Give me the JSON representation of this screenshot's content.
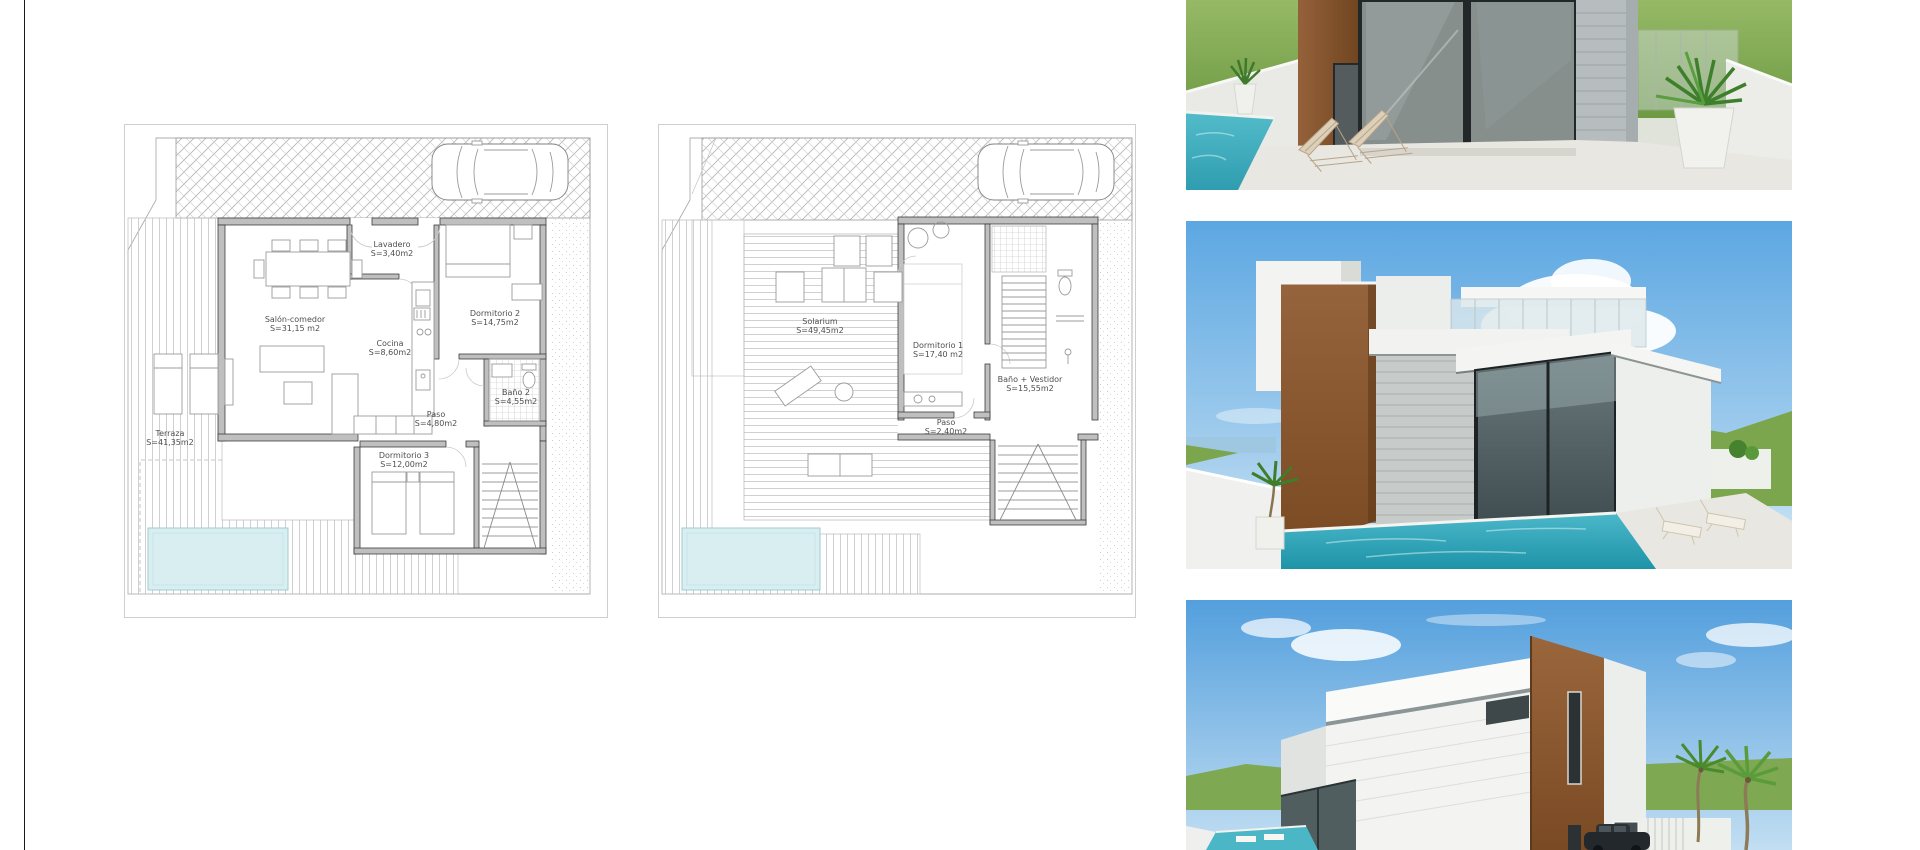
{
  "plans": [
    {
      "name": "ground-floor-plan",
      "rooms": [
        {
          "label": "Salón-comedor",
          "area": "S=31,15 m2"
        },
        {
          "label": "Lavadero",
          "area": "S=3,40m2"
        },
        {
          "label": "Cocina",
          "area": "S=8,60m2"
        },
        {
          "label": "Dormitorio 2",
          "area": "S=14,75m2"
        },
        {
          "label": "Baño 2",
          "area": "S=4,55m2"
        },
        {
          "label": "Paso",
          "area": "S=4,80m2"
        },
        {
          "label": "Dormitorio 3",
          "area": "S=12,00m2"
        },
        {
          "label": "Terraza",
          "area": "S=41,35m2"
        }
      ]
    },
    {
      "name": "first-floor-plan",
      "rooms": [
        {
          "label": "Solarium",
          "area": "S=49,45m2"
        },
        {
          "label": "Dormitorio 1",
          "area": "S=17,40 m2"
        },
        {
          "label": "Baño + Vestidor",
          "area": "S=15,55m2"
        },
        {
          "label": "Paso",
          "area": "S=2,40m2"
        }
      ]
    }
  ],
  "renders": [
    {
      "name": "terrace-pool-render"
    },
    {
      "name": "villa-pool-aerial-render"
    },
    {
      "name": "villa-street-corner-render"
    }
  ],
  "colors": {
    "sheet_background": "#ffffff",
    "frame_line": "#1a1a1a",
    "plan_wall": "#3e3e3e",
    "plan_pool": "#d9eef0",
    "sky": "#5ca7e2",
    "grass": "#7ba64d",
    "corten_brown": "#8a5a33",
    "pool_water": "#3fb0c4",
    "glass": "#76817f",
    "concrete": "#b8bec0"
  }
}
